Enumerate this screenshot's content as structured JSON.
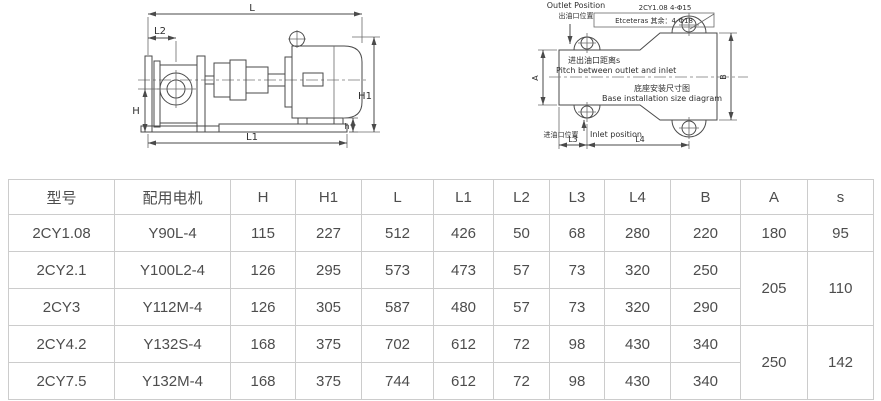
{
  "colors": {
    "background": "#ffffff",
    "drawing_line": "#4a4a4a",
    "table_border": "#cccccc",
    "table_text": "#4d4d4d"
  },
  "left_diagram": {
    "description": "pump with motor side view",
    "dim_labels": {
      "L": "L",
      "L2": "L2",
      "H": "H",
      "H1": "H1",
      "h": "h",
      "L1": "L1"
    }
  },
  "right_diagram": {
    "outlet_en": "Outlet Position",
    "outlet_zh": "出油口位置",
    "callout_line1": "2CY1.08 4-Φ15",
    "callout_line2": "Etceteras 其余：4-Φ18",
    "pitch_zh": "进出油口距离s",
    "pitch_en": "Pitch between outlet and inlet",
    "title_zh": "底座安装尺寸图",
    "title_en": "Base installation size diagram",
    "inlet_zh": "进油口位置",
    "inlet_en": "Inlet position",
    "dim_labels": {
      "A": "A",
      "B": "B",
      "L3": "L3",
      "L4": "L4"
    }
  },
  "table": {
    "headers": [
      "型号",
      "配用电机",
      "H",
      "H1",
      "L",
      "L1",
      "L2",
      "L3",
      "L4",
      "B",
      "A",
      "s"
    ],
    "rows": [
      [
        "2CY1.08",
        "Y90L-4",
        "115",
        "227",
        "512",
        "426",
        "50",
        "68",
        "280",
        "220",
        "180",
        "95"
      ],
      [
        "2CY2.1",
        "Y100L2-4",
        "126",
        "295",
        "573",
        "473",
        "57",
        "73",
        "320",
        "250",
        "205",
        "110"
      ],
      [
        "2CY3",
        "Y112M-4",
        "126",
        "305",
        "587",
        "480",
        "57",
        "73",
        "320",
        "290"
      ],
      [
        "2CY4.2",
        "Y132S-4",
        "168",
        "375",
        "702",
        "612",
        "72",
        "98",
        "430",
        "340",
        "250",
        "142"
      ],
      [
        "2CY7.5",
        "Y132M-4",
        "168",
        "375",
        "744",
        "612",
        "72",
        "98",
        "430",
        "340"
      ]
    ]
  }
}
